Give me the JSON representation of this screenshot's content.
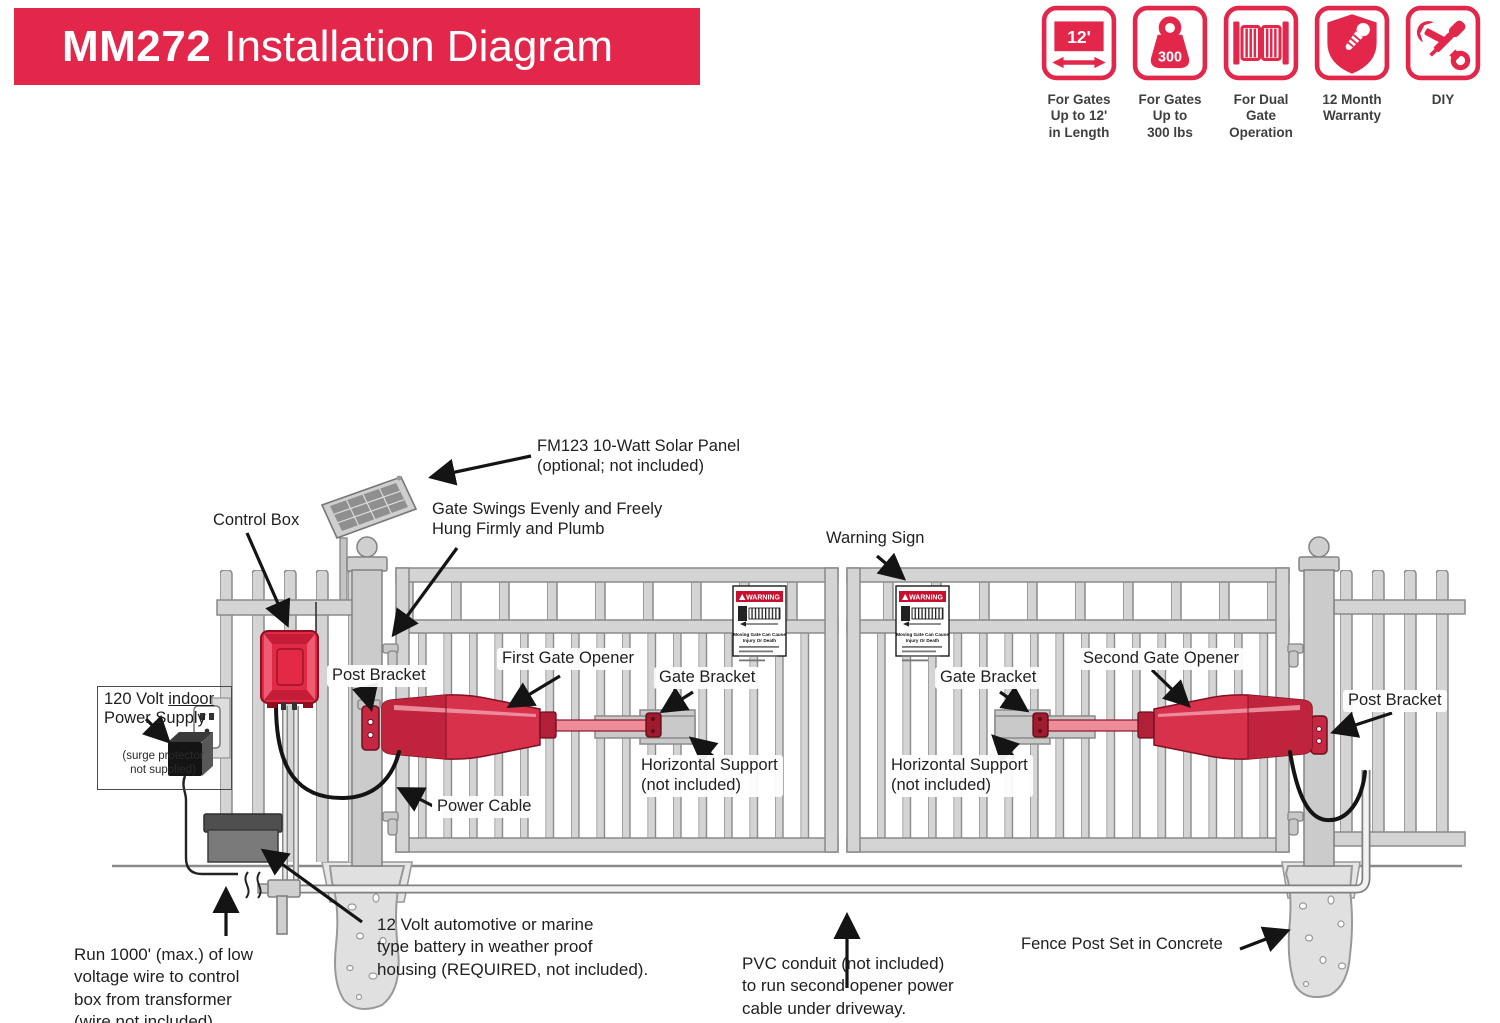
{
  "header": {
    "model": "MM272",
    "title": "Installation Diagram",
    "bg_color": "#E3274B"
  },
  "badges": [
    {
      "icon": "gate-length-icon",
      "icon_text": "12'",
      "label": "For Gates\nUp to 12'\nin Length"
    },
    {
      "icon": "gate-weight-icon",
      "icon_text": "300",
      "label": "For Gates\nUp to\n300 lbs"
    },
    {
      "icon": "dual-gate-icon",
      "label": "For Dual Gate\nOperation"
    },
    {
      "icon": "warranty-shield-icon",
      "label": "12 Month\nWarranty"
    },
    {
      "icon": "diy-tools-icon",
      "label": "DIY"
    }
  ],
  "colors": {
    "accent_red": "#E3274B",
    "opener_red": "#D8314B",
    "metal_gray": "#D4D4D4"
  },
  "diagram": {
    "labels": {
      "solar_panel": "FM123 10-Watt Solar Panel\n(optional; not included)",
      "control_box": "Control Box",
      "gate_swing": "Gate Swings Evenly and Freely\nHung Firmly and Plumb",
      "warning_sign": "Warning Sign",
      "post_bracket_left": "Post Bracket",
      "first_gate_opener": "First Gate Opener",
      "gate_bracket_left": "Gate Bracket",
      "horizontal_support_left": "Horizontal Support\n(not included)",
      "gate_bracket_right": "Gate Bracket",
      "second_gate_opener": "Second Gate Opener",
      "horizontal_support_right": "Horizontal Support\n(not included)",
      "post_bracket_right": "Post Bracket",
      "power_cable": "Power Cable",
      "run_wire": "Run 1000' (max.) of low\nvoltage wire to control\nbox from transformer\n(wire not included).",
      "battery": "12 Volt automotive or marine\ntype battery in weather proof\nhousing (REQUIRED, not included).",
      "pvc_conduit": "PVC conduit (not included)\nto run second opener power\ncable under driveway.",
      "fence_post": "Fence Post Set in Concrete"
    },
    "power_supply": {
      "line1_prefix": "120 Volt ",
      "line1_underlined": "indoor",
      "line2": "Power Supply",
      "note": "(surge protector\nnot supplied)"
    },
    "warning_sign": {
      "header": "WARNING",
      "line1": "Moving Gate Can Cause",
      "line2": "Injury Or Death"
    }
  }
}
